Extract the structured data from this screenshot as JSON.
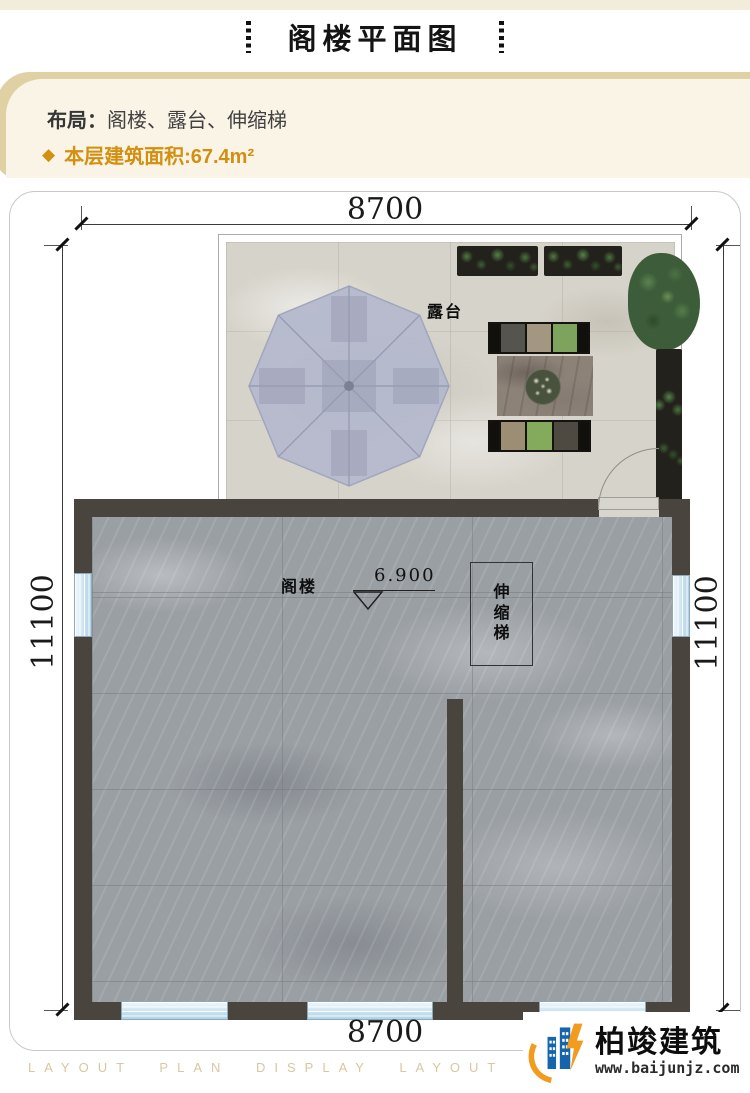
{
  "header": {
    "title": "阁楼平面图"
  },
  "info": {
    "layout_label": "布局：",
    "layout_value": "阁楼、露台、伸缩梯",
    "diamond_icon": "◆",
    "area_label": "本层建筑面积:67.4m²",
    "accent_color": "#d28f10",
    "panel_bg": "#faf4e6",
    "panel_edge": "#e0d1a4"
  },
  "dimensions": {
    "top": "8700",
    "bottom": "8700",
    "left": "11100",
    "right": "11100"
  },
  "plan": {
    "labels": {
      "terrace": "露台",
      "attic": "阁楼",
      "ladder": "伸缩梯",
      "elevation": "6.900"
    },
    "colors": {
      "wall": "#49453e",
      "marble_floor": "#9a9fa4",
      "terrace_floor": "#d6d3ca",
      "window_blue": "#aed2e6",
      "umbrella": "#b5b9cd",
      "umbrella_rib": "#989cb3",
      "umbrella_shadow": "#7c8097"
    },
    "terrace": {
      "bench_top_cushions": [
        "#55544e",
        "#a39781",
        "#7ea35d"
      ],
      "bench_bottom_cushions": [
        "#9c8e74",
        "#84ab5c",
        "#4e4a42"
      ]
    }
  },
  "footer": {
    "watermark": "LAYOUT PLAN DISPLAY LAYOUT PLAN DI",
    "brand_name": "柏竣建筑",
    "brand_url": "www.baijunjz.com",
    "brand_blue": "#1565ad",
    "brand_orange": "#f29b1d"
  }
}
